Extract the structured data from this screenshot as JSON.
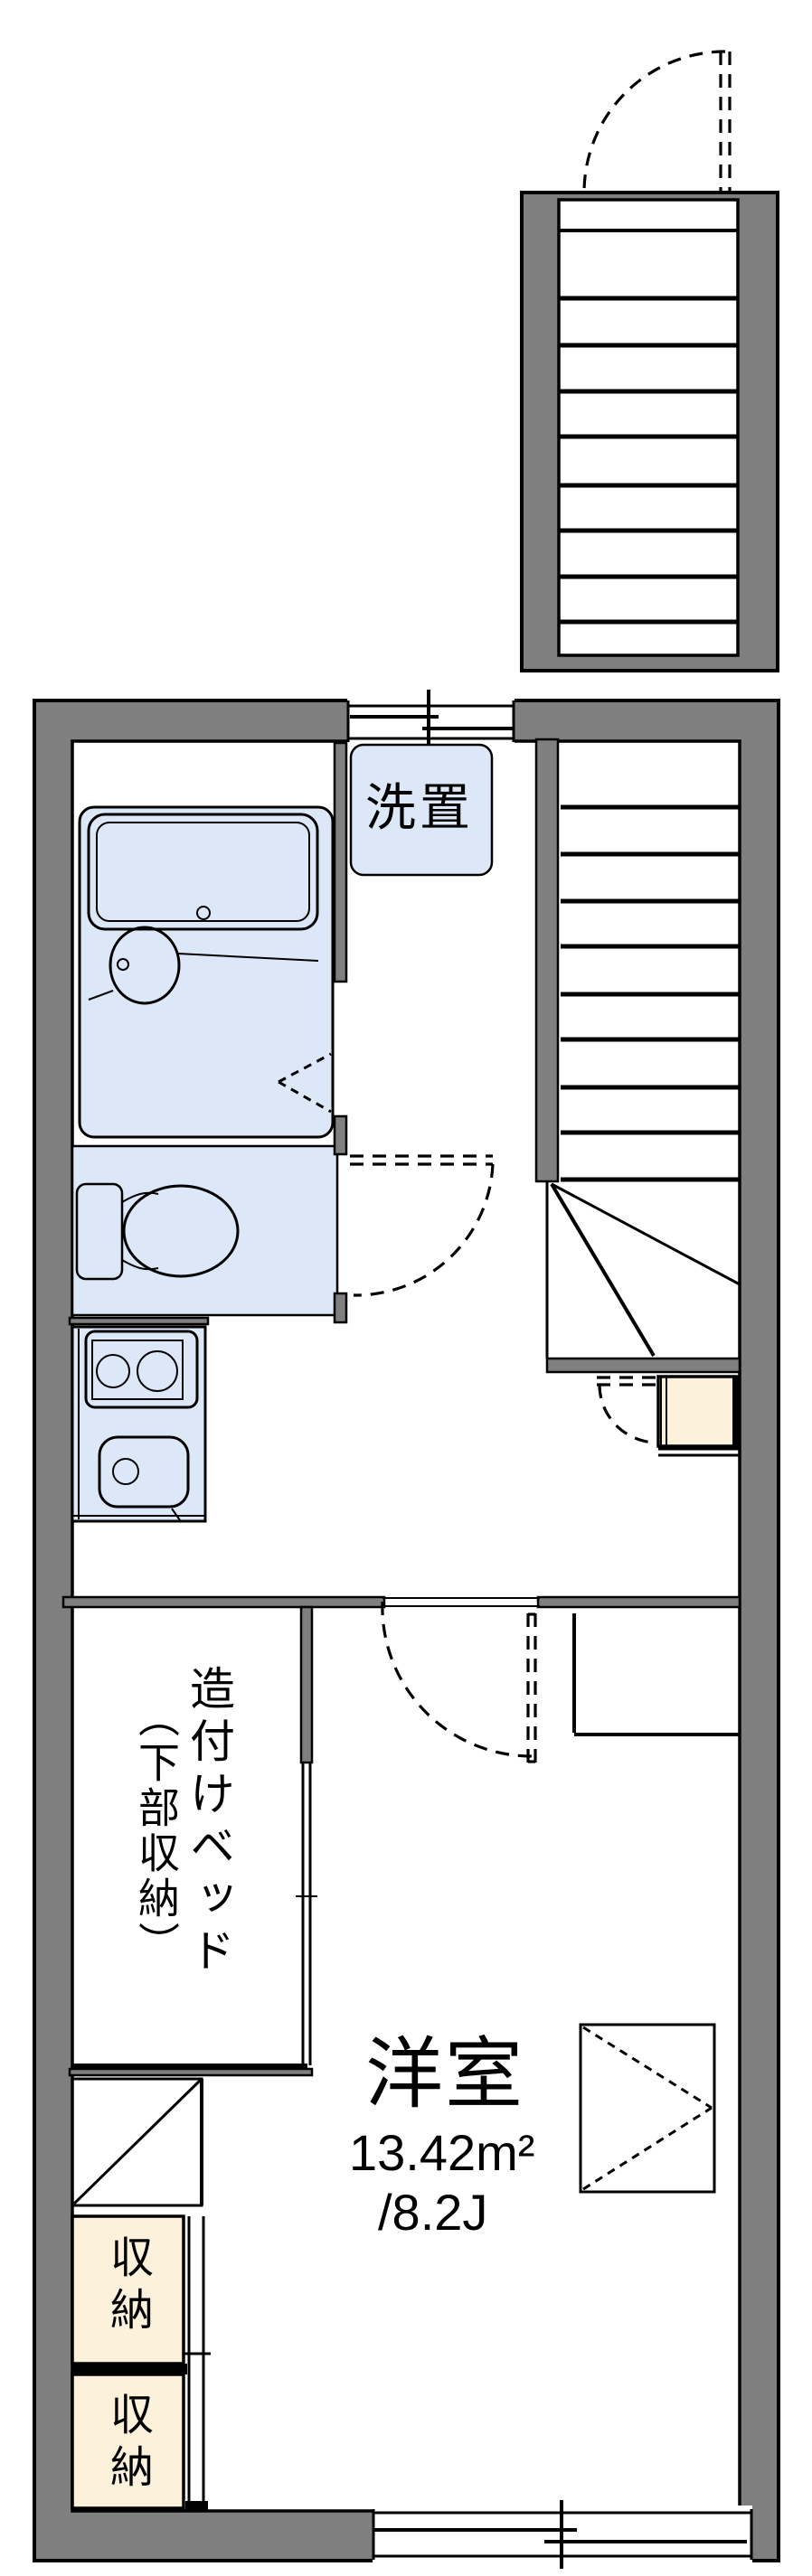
{
  "floorplan": {
    "labels": {
      "washer": "洗置",
      "bed_line1": "造付けベッド",
      "bed_line2": "（下部収納）",
      "room_name": "洋室",
      "room_area": "13.42m²",
      "room_tatami": "/8.2J",
      "storage_upper": "収納",
      "storage_lower": "収納"
    },
    "colors": {
      "wall_gray": "#7f7f7f",
      "fixture_blue": "#dce7f8",
      "storage_cream": "#fcf1da",
      "line_black": "#000000",
      "background_white": "#ffffff"
    }
  }
}
